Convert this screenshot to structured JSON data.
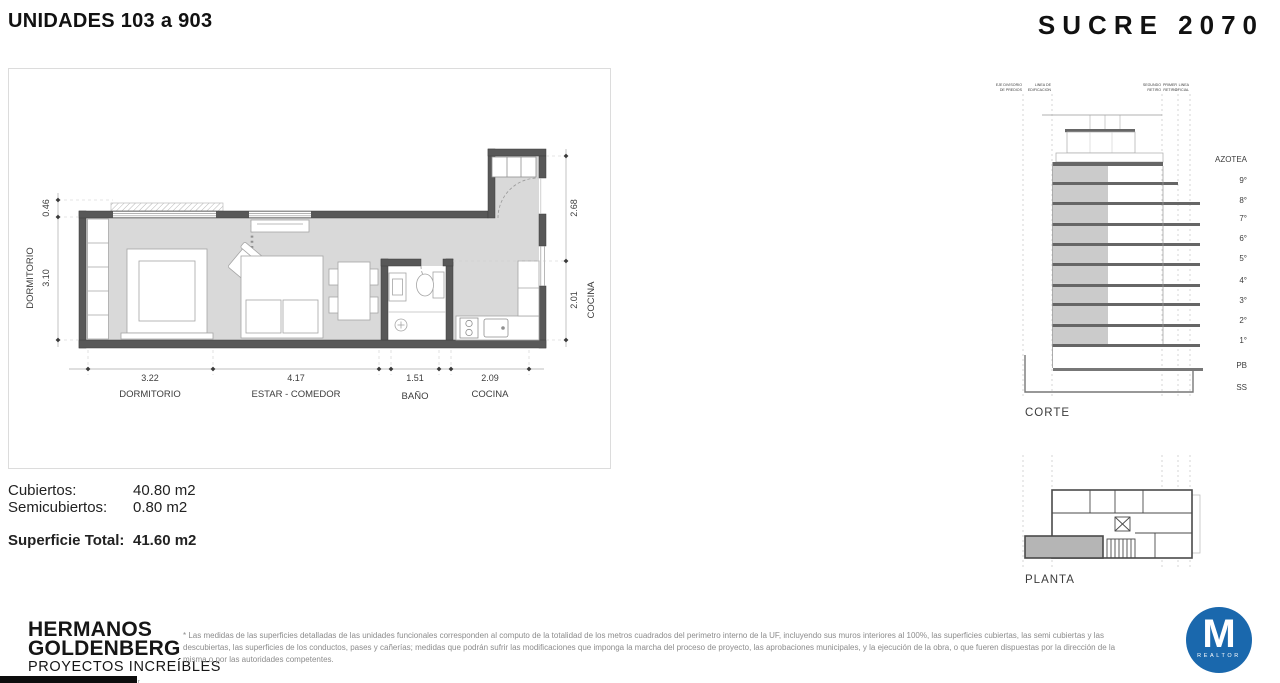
{
  "header": {
    "units_title": "UNIDADES 103 a 903",
    "project_title": "SUCRE 2070"
  },
  "floorplan": {
    "dims": {
      "left_top": "0.46",
      "left_main": "3.10",
      "right_top": "2.68",
      "right_bottom": "2.01",
      "bottom": [
        {
          "value": "3.22",
          "label": "DORMITORIO"
        },
        {
          "value": "4.17",
          "label": "ESTAR - COMEDOR"
        },
        {
          "value": "1.51",
          "label": "BAÑO"
        },
        {
          "value": "2.09",
          "label": "COCINA"
        }
      ]
    },
    "labels": {
      "left_room": "DORMITORIO",
      "right_room": "COCINA"
    }
  },
  "surfaces": {
    "rows": [
      {
        "label": "Cubiertos:",
        "value": "40.80 m2"
      },
      {
        "label": "Semicubiertos:",
        "value": "0.80 m2"
      }
    ],
    "total": {
      "label": "Superficie Total:",
      "value": "41.60 m2"
    }
  },
  "corte": {
    "title": "CORTE",
    "floors": [
      "AZOTEA",
      "9°",
      "8°",
      "7°",
      "6°",
      "5°",
      "4°",
      "3°",
      "2°",
      "1°",
      "PB",
      "SS"
    ],
    "reference_lines": [
      {
        "line1": "EJE DIVISORIO",
        "line2": "DE PREDIOS"
      },
      {
        "line1": "LINEA DE",
        "line2": "EDIFICACION"
      },
      {
        "line1": "SEGUNDO",
        "line2": "RETIRO"
      },
      {
        "line1": "PRIMER",
        "line2": "RETIRO"
      },
      {
        "line1": "LINEA",
        "line2": "OFICIAL"
      }
    ]
  },
  "planta": {
    "title": "PLANTA"
  },
  "footer": {
    "company_line1": "HERMANOS",
    "company_line2": "GOLDENBERG",
    "tagline": "PROYECTOS INCREÍBLES",
    "website": "www.hermanosgoldenberg.com.ar",
    "disclaimer": "* Las medidas de las superficies detalladas de las unidades funcionales corresponden al computo de la totalidad de los metros cuadrados del perimetro interno de la UF, incluyendo sus muros interiores al 100%, las superficies cubiertas, las semi cubiertas y las descubiertas, las superficies de los conductos, pases y cañerías; medidas que podrán sufrir las modificaciones que imponga la marcha del proceso de proyecto, las aprobaciones municipales, y la ejecución de la obra, o que fueren dispuestas por la dirección de la misma o por las autoridades competentes.",
    "realtor": {
      "letter": "M",
      "label": "REALTOR",
      "color": "#1a68ad"
    }
  },
  "colors": {
    "wall_gray": "#585858",
    "floor_gray": "#d9d9d9",
    "realtor_blue": "#1a68ad"
  }
}
